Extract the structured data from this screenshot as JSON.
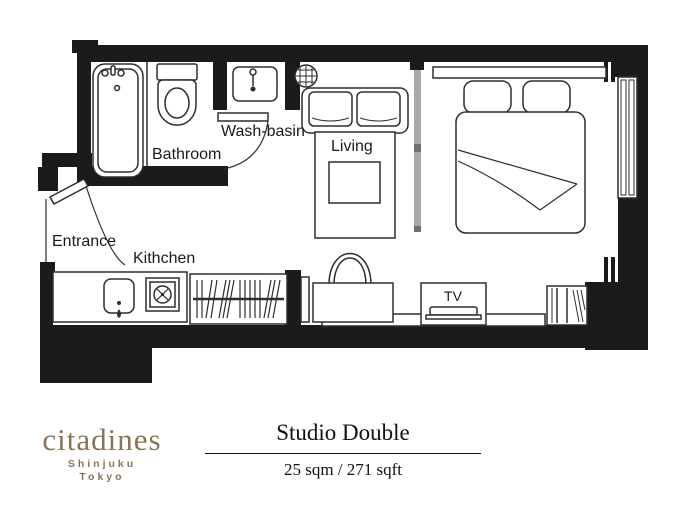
{
  "plan": {
    "labels": {
      "bathroom": "Bathroom",
      "washbasin": "Wash-basin",
      "living": "Living",
      "entrance": "Entrance",
      "kitchen": "Kithchen",
      "tv": "TV"
    }
  },
  "branding": {
    "logo_text": "citadines",
    "location_line1": "Shinjuku",
    "location_line2": "Tokyo",
    "logo_color": "#8a7457"
  },
  "room_info": {
    "name": "Studio Double",
    "area": "25 sqm / 271 sqft"
  },
  "colors": {
    "wall": "#1b1b1b",
    "line": "#2e2e2e",
    "partition": "#a8a8a8",
    "background": "#ffffff"
  }
}
